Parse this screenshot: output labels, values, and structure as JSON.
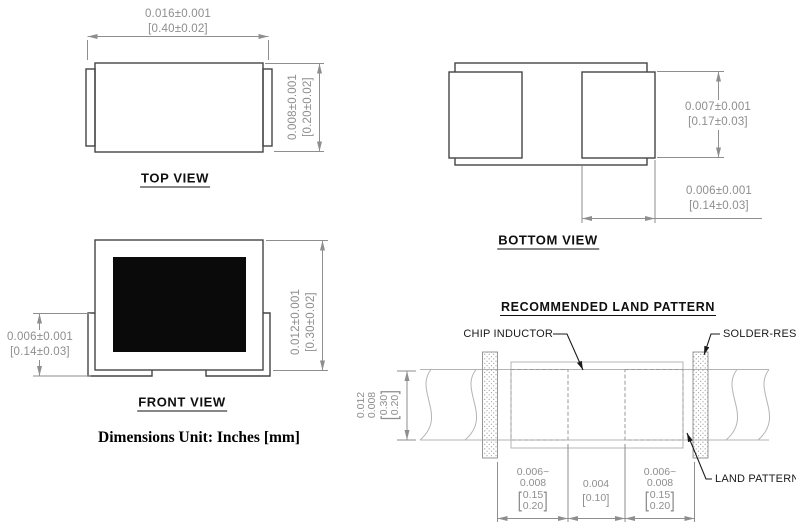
{
  "glyphs": {
    "bracket_open": "[",
    "bracket_close": "]"
  },
  "colors": {
    "outline": "#454545",
    "dimension": "#8e8e8e",
    "light_outline": "#b4b4b4",
    "callout": "#1a1a1a",
    "core_fill": "#0a0a0a"
  },
  "top_view": {
    "label": "TOP VIEW",
    "width_dim": {
      "inch": "0.016±0.001",
      "mm": "[0.40±0.02]"
    },
    "height_dim": {
      "inch": "0.008±0.001",
      "mm": "[0.20±0.02]"
    }
  },
  "bottom_view": {
    "label": "BOTTOM VIEW",
    "pad_height_dim": {
      "inch": "0.007±0.001",
      "mm": "[0.17±0.03]"
    },
    "pad_width_dim": {
      "inch": "0.006±0.001",
      "mm": "[0.14±0.03]"
    }
  },
  "front_view": {
    "label": "FRONT VIEW",
    "terminal_dim": {
      "inch": "0.006±0.001",
      "mm": "[0.14±0.03]"
    },
    "height_dim": {
      "inch": "0.012±0.001",
      "mm": "[0.30±0.02]"
    }
  },
  "units_note": "Dimensions Unit: Inches [mm]",
  "land_pattern": {
    "title": "RECOMMENDED LAND PATTERN",
    "callout_chip": "CHIP INDUCTOR",
    "callout_solder": "SOLDER-RESIST",
    "callout_land": "LAND PATTERN",
    "pad_width_left": {
      "inch1": "0.006~",
      "inch2": "0.008",
      "mm1": "0.15",
      "mm2": "0.20"
    },
    "gap_dim": {
      "inch1": "0.004",
      "mm1": "0.10"
    },
    "pad_width_right": {
      "inch1": "0.006~",
      "inch2": "0.008",
      "mm1": "0.15",
      "mm2": "0.20"
    },
    "trace_height_dim": {
      "inch1": "0.012",
      "inch2": "0.008",
      "mm1": "0.30",
      "mm2": "0.20"
    }
  }
}
